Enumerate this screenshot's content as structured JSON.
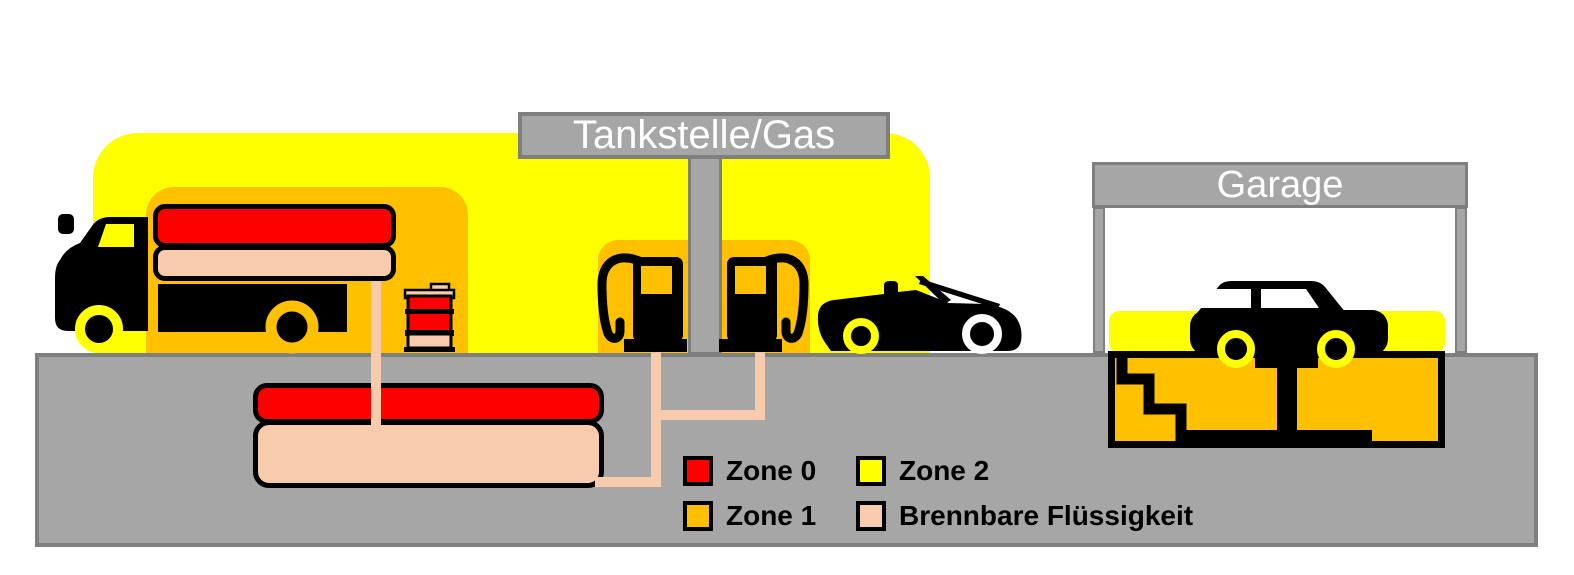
{
  "station_sign": {
    "label": "Tankstelle/Gas"
  },
  "garage_sign": {
    "label": "Garage"
  },
  "legend": {
    "items": [
      {
        "label": "Zone 0",
        "color": "#FF0000"
      },
      {
        "label": "Zone 1",
        "color": "#FFC000"
      },
      {
        "label": "Zone 2",
        "color": "#FFFF00"
      },
      {
        "label": "Brennbare Flüssigkeit",
        "color": "#F8CBAD"
      }
    ]
  },
  "colors": {
    "zone0": "#FF0000",
    "zone1": "#FFC000",
    "zone2": "#FFFF00",
    "flammable_liquid": "#F8CBAD",
    "ground": "#A6A6A6",
    "frame": "#7F7F7F"
  }
}
